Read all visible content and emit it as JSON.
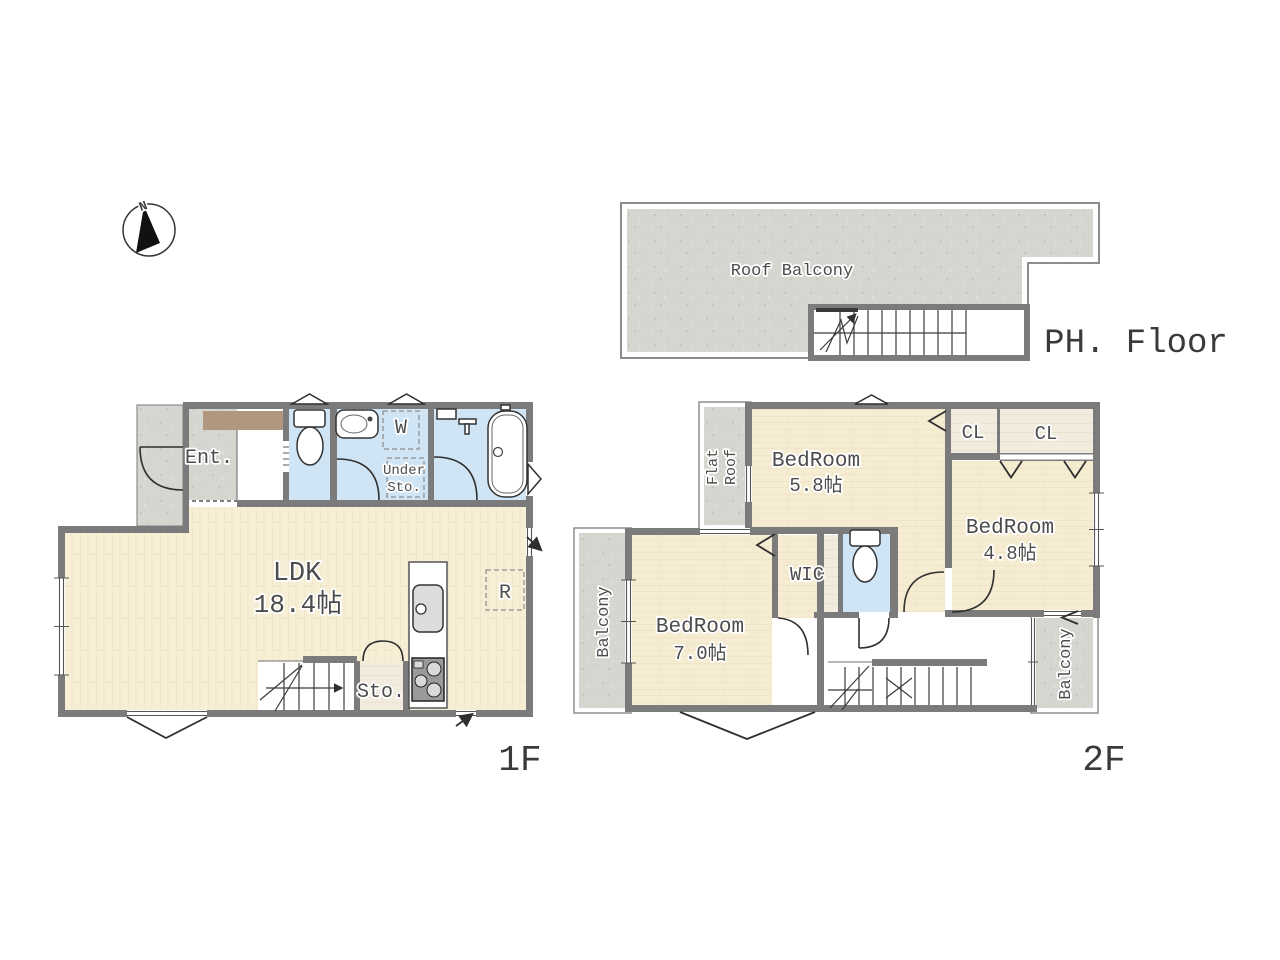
{
  "compass": {
    "north_label": "N"
  },
  "colors": {
    "wall": "#7b7b7b",
    "thin_outline": "#8d8d8d",
    "wood_floor": "#f7eed6",
    "wet_area_blue": "#cfe4f4",
    "concrete_gray": "#d6d6d1",
    "closet_floor": "#f1ecdd",
    "entrance_mat_brown": "#b29780",
    "label_text": "#4c4c4c"
  },
  "ph": {
    "floor_label": "PH. Floor",
    "roof_balcony_label": "Roof Balcony"
  },
  "f1": {
    "floor_label": "1F",
    "entrance_label": "Ent.",
    "washer_label": "W",
    "under_storage_line1": "Under",
    "under_storage_line2": "Sto.",
    "ldk_name": "LDK",
    "ldk_area": "18.4帖",
    "refrigerator_label": "R",
    "storage_label": "Sto."
  },
  "f2": {
    "floor_label": "2F",
    "flat_roof_line1": "Flat",
    "flat_roof_line2": "Roof",
    "bedroom_a_name": "BedRoom",
    "bedroom_a_area": "5.8帖",
    "closet_a_label": "CL",
    "closet_b_label": "CL",
    "bedroom_b_name": "BedRoom",
    "bedroom_b_area": "4.8帖",
    "wic_label": "WIC",
    "bedroom_c_name": "BedRoom",
    "bedroom_c_area": "7.0帖",
    "balcony_left_label": "Balcony",
    "balcony_right_label": "Balcony"
  }
}
